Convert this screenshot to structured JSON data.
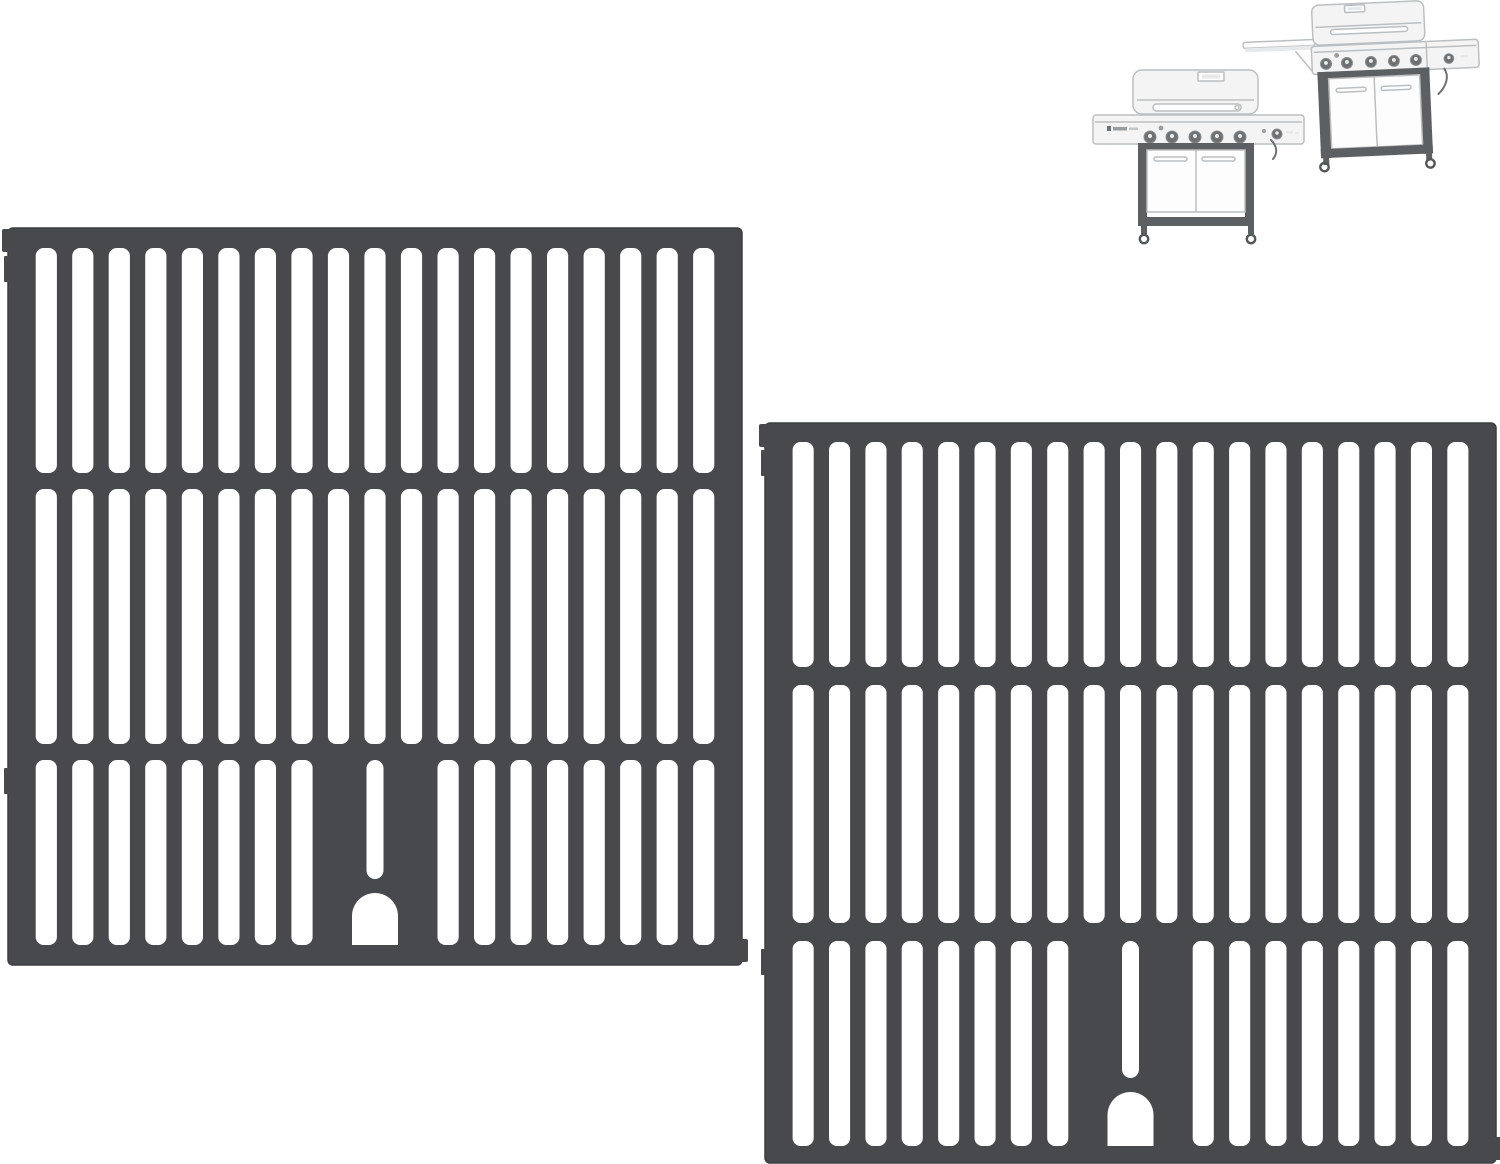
{
  "image": {
    "description": "Product photo: two-pack matte cast-iron grill cooking grates shown on white, with two light gray gas-grill reference drawings in the upper right corner",
    "width": 1500,
    "height": 1164,
    "background": "#ffffff"
  },
  "palette": {
    "grate": "#47494c",
    "grate_edge": "#3c3e41",
    "slot": "#ffffff",
    "thumb_line": "#bcbfc1",
    "thumb_fill": "#f4f4f5",
    "thumb_fill2": "#e7e8e9",
    "thumb_frame": "#5d6063",
    "thumb_knob": "#6e7174"
  },
  "grates": {
    "count": 2,
    "material": "cast-iron cooking grid",
    "rows": 3,
    "columns": 19,
    "items": [
      {
        "id": "left",
        "x": 8,
        "y": 228,
        "w": 734,
        "h": 737,
        "frame_top": 20,
        "frame_side": 20,
        "crossbar": 16,
        "row_heights": [
          225,
          255,
          185
        ],
        "slot_ratio": 0.58,
        "arch_cutout": {
          "width": 46,
          "height": 52,
          "gap": 14,
          "narrow_slot_width": 17
        }
      },
      {
        "id": "right",
        "x": 765,
        "y": 423,
        "w": 731,
        "h": 740,
        "frame_top": 19,
        "frame_side": 20,
        "crossbar": 18,
        "row_heights": [
          225,
          238,
          205
        ],
        "slot_ratio": 0.58,
        "arch_cutout": {
          "width": 46,
          "height": 54,
          "gap": 14,
          "narrow_slot_width": 17
        }
      }
    ]
  },
  "grill_thumbnails": {
    "count": 2,
    "items": [
      {
        "id": "front-view",
        "doors": 2,
        "casters": 2,
        "burner_knobs": {
          "xs": [
            65,
            87,
            110,
            132,
            155
          ],
          "y": 79,
          "r": 6
        },
        "igniter": {
          "x": 76,
          "y": 70,
          "r": 2.4
        },
        "side_knob": {
          "x": 192,
          "y": 76,
          "r": 5
        }
      },
      {
        "id": "angled-view",
        "doors": 2,
        "casters": 2,
        "side_shelf": true,
        "burner_knobs": {
          "xs": [
            87,
            108,
            132,
            155,
            177
          ],
          "y": 62,
          "r": 5.5
        },
        "igniter": {
          "x": 98,
          "y": 54,
          "r": 2.4
        },
        "side_knob": {
          "x": 210,
          "y": 62,
          "r": 4.8
        }
      }
    ]
  }
}
